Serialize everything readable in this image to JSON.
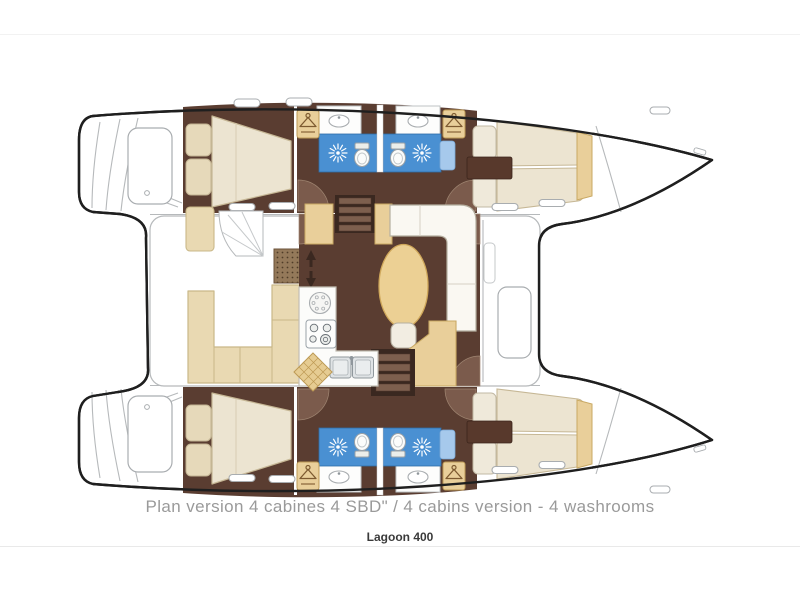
{
  "page": {
    "background": "#ffffff",
    "top_divider_color": "#f2f2f2",
    "bottom_divider_color": "#e9e9e9"
  },
  "caption": {
    "text": "Plan version 4 cabines 4 SBD\" / 4 cabins version - 4 washrooms"
  },
  "model": {
    "text": "Lagoon 400"
  },
  "plan": {
    "type": "catamaran-floor-plan",
    "cabins": 4,
    "washrooms": 4,
    "colors": {
      "hull_outline": "#1f1f1f",
      "structure_line": "#b6b9bb",
      "cabin_floor_brown": "#5a3d31",
      "stairs_dark_brown": "#3a2820",
      "door_arc_brown": "#7b5b4c",
      "bathroom_floor_blue": "#4a90d2",
      "shower_bench_blue": "#a6c9ec",
      "bed_cream": "#ece4d1",
      "pillow_beige": "#e6d9ba",
      "accent_tan": "#e9cf9a",
      "cockpit_seat_beige": "#e9d9b2",
      "table_gold": "#ecd094",
      "sofa_white": "#faf8f2",
      "caption_gray": "#9a9a9a",
      "model_text": "#3a3a3a"
    },
    "icons": {
      "shower_icon": "sunburst-rays",
      "hanger_icon": "clothes-hanger",
      "toilet_icon": "toilet-bowl-with-tank",
      "sink_icon": "oval-basin",
      "stove_icon": "four-burner-hob",
      "round_sink_icon": "round-sink-with-dots",
      "double_sink_icon": "twin-square-basins",
      "stairs_icon": "companionway-steps",
      "direction_arrows_icon": "up-down-arrows",
      "hatch_icon": "rounded-deck-hatch",
      "window_icon": "hull-window-slot"
    }
  }
}
